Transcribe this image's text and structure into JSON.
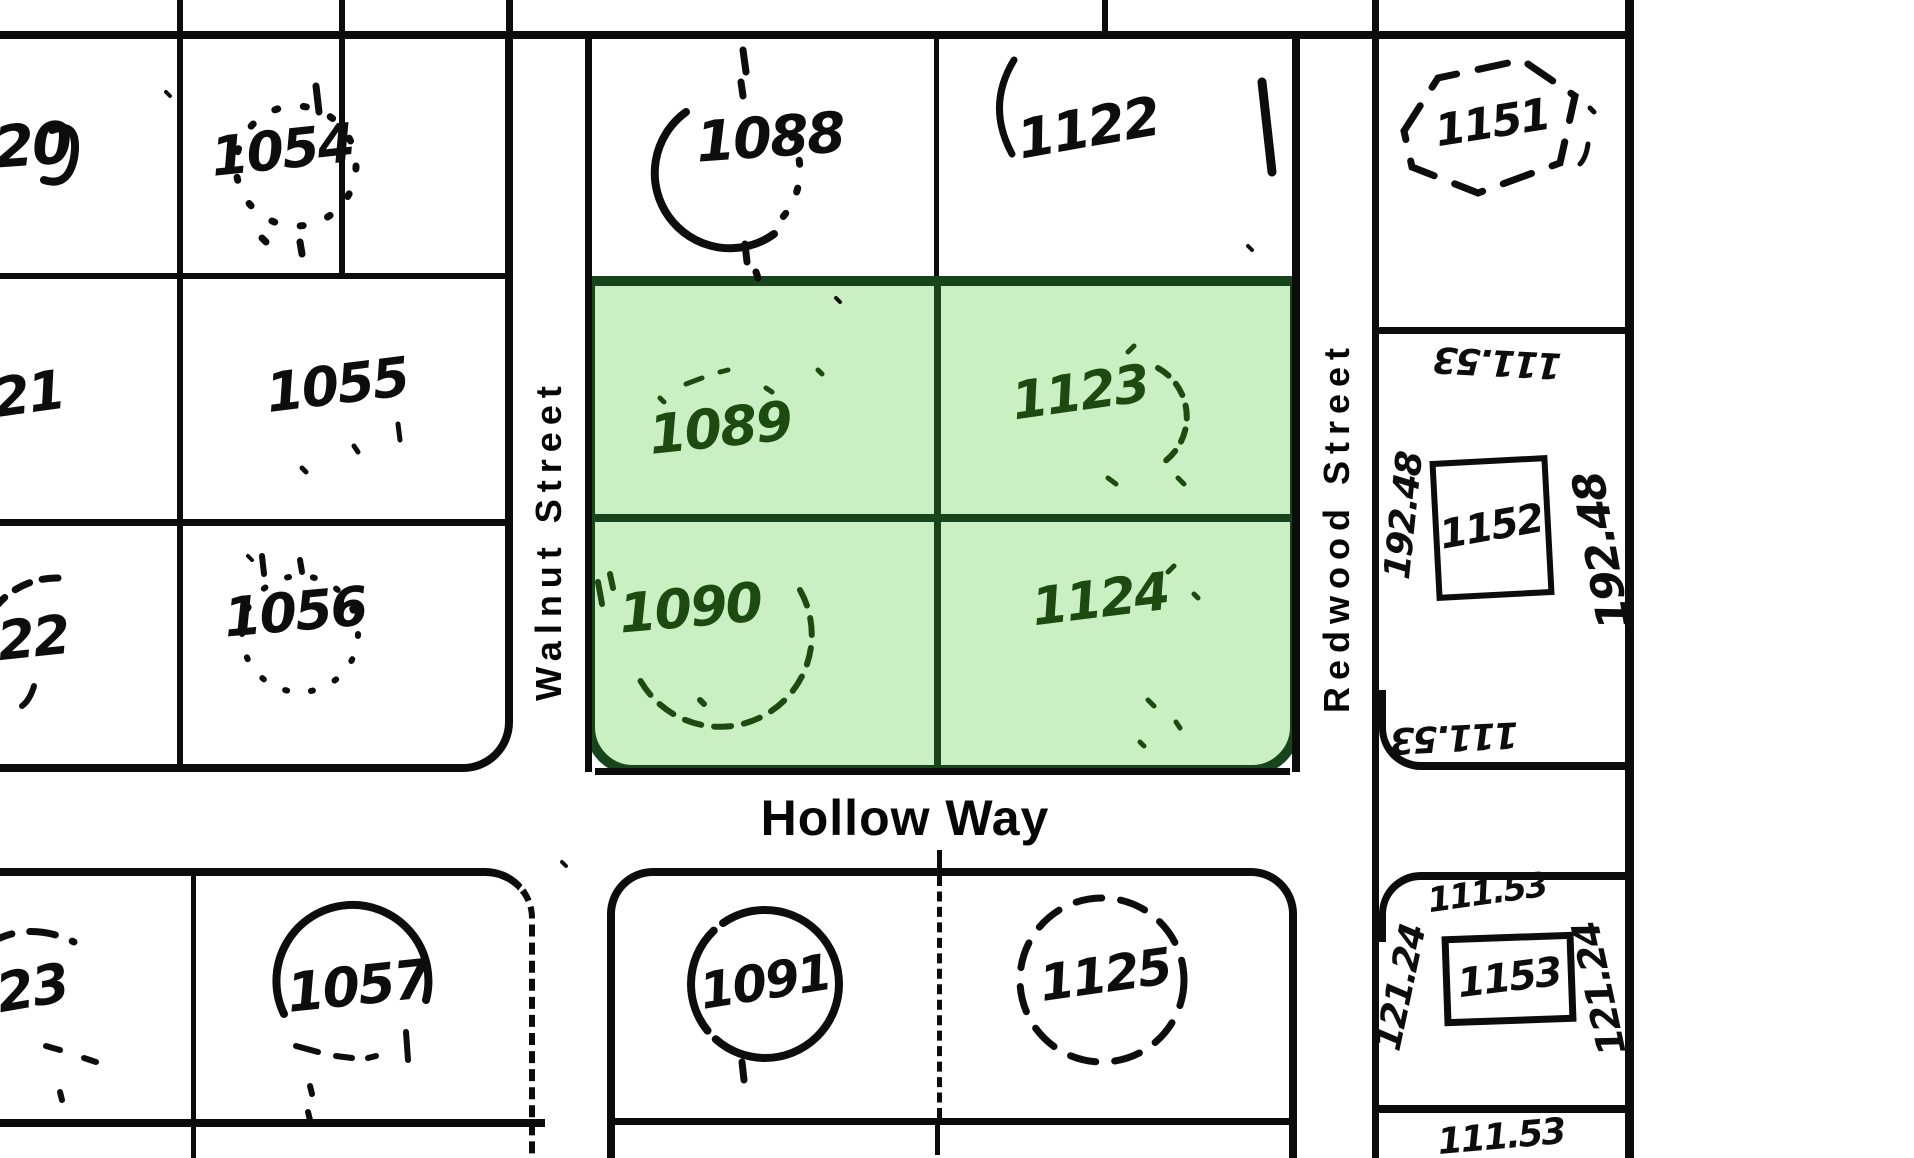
{
  "streets": {
    "walnut": "Walnut Street",
    "redwood": "Redwood Street",
    "hollow": "Hollow Way"
  },
  "selected_lots": [
    "1089",
    "1123",
    "1090",
    "1124"
  ],
  "colors": {
    "paper": "#ffffff",
    "ink": "#0c0c0c",
    "highlight_fill": "#c9efc3",
    "highlight_border": "#17441a",
    "green_ink": "#1d4a10"
  },
  "lots": {
    "n20": "20",
    "n21": "21",
    "n22": "22",
    "n23": "23",
    "n1054": "1054",
    "n1055": "1055",
    "n1056": "1056",
    "n1057": "1057",
    "n1088": "1088",
    "n1089": "1089",
    "n1090": "1090",
    "n1091": "1091",
    "n1122": "1122",
    "n1123": "1123",
    "n1124": "1124",
    "n1125": "1125",
    "n1151": "1151",
    "n1152": "1152",
    "n1153": "1153"
  },
  "measurements": {
    "m1152_top": "111.53",
    "m1152_left": "192.48",
    "m1152_right": "192.48",
    "m1152_bottom": "111.53",
    "m1153_top": "111.53",
    "m1153_left": "121.24",
    "m1153_right": "121.24",
    "m1153_bottom": "111.53"
  }
}
